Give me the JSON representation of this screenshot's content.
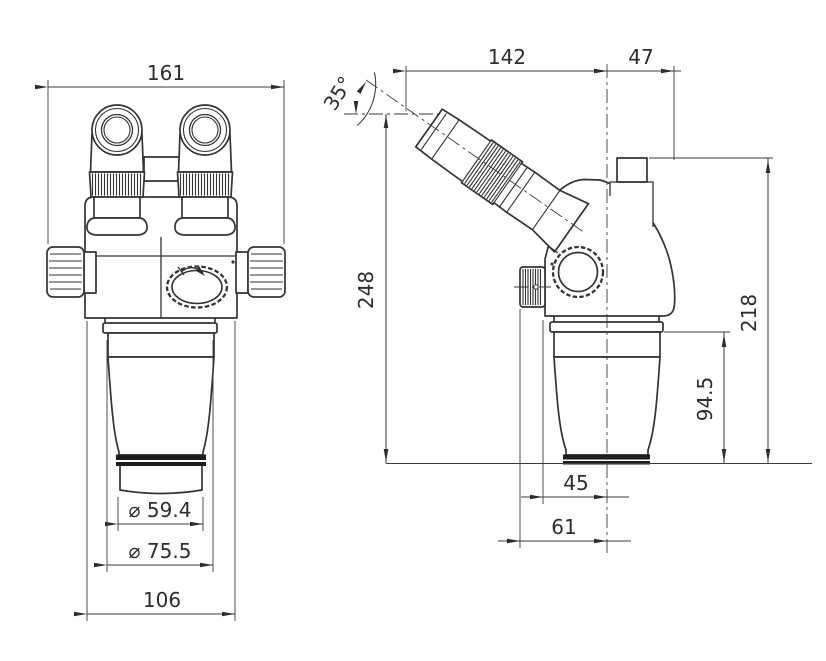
{
  "page": {
    "background": "#ffffff",
    "line_color": "#333333",
    "text_color": "#2d2d2d",
    "description": "Dimensioned engineering drawing of a stereo microscope head, front view and side view"
  },
  "front_view": {
    "label": "front-view",
    "dim_overall_width": "161",
    "dim_lens_inner_dia": "⌀ 59.4",
    "dim_lens_outer_dia": "⌀ 75.5",
    "dim_body_width": "106"
  },
  "side_view": {
    "label": "side-view",
    "dim_eyepiece_angle": "35°",
    "dim_eyepiece_reach": "142",
    "dim_port_offset": "47",
    "dim_overall_height": "248",
    "dim_body_height": "218",
    "dim_objective_height": "94.5",
    "dim_front_offset": "45",
    "dim_knob_offset": "61"
  }
}
